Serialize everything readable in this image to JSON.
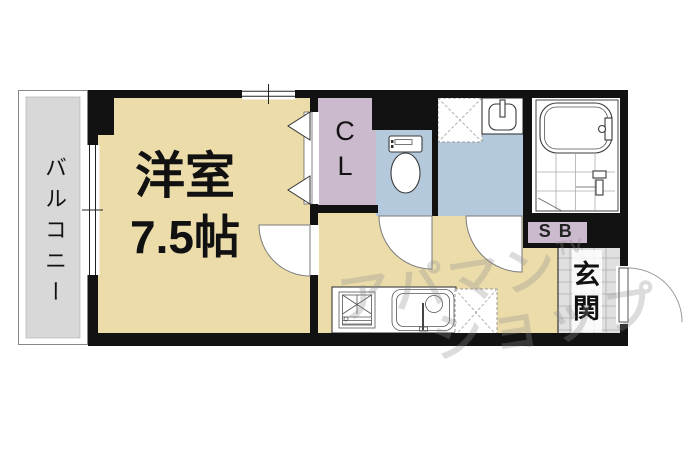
{
  "palette": {
    "wall": "#121212",
    "beige": "#EBDCAA",
    "grey": "#D8D8D8",
    "lavender": "#CBBACD",
    "blue": "#B4CADC",
    "tile": "#E0E0E0",
    "tileline": "#A8ADB4",
    "watermark": "#8E8E8E"
  },
  "rooms": {
    "balcony": {
      "label": "バルコニー"
    },
    "main_room": {
      "label": "洋室",
      "size": "7.5帖"
    },
    "closet": {
      "label": "CL"
    },
    "storage": {
      "label": "SB"
    },
    "entrance": {
      "label": "玄関"
    }
  },
  "watermark": {
    "line1": "アパマン",
    "superscript": "TV",
    "line2": "ショップ"
  },
  "icons": [
    "toilet-icon",
    "bathtub-icon",
    "shower-faucet-icon",
    "washing-machine-space-icon",
    "vanity-sink-icon",
    "stove-icon",
    "kitchen-sink-icon",
    "refrigerator-space-icon",
    "door-swing-arc",
    "folding-door-icon",
    "window-symbol"
  ]
}
